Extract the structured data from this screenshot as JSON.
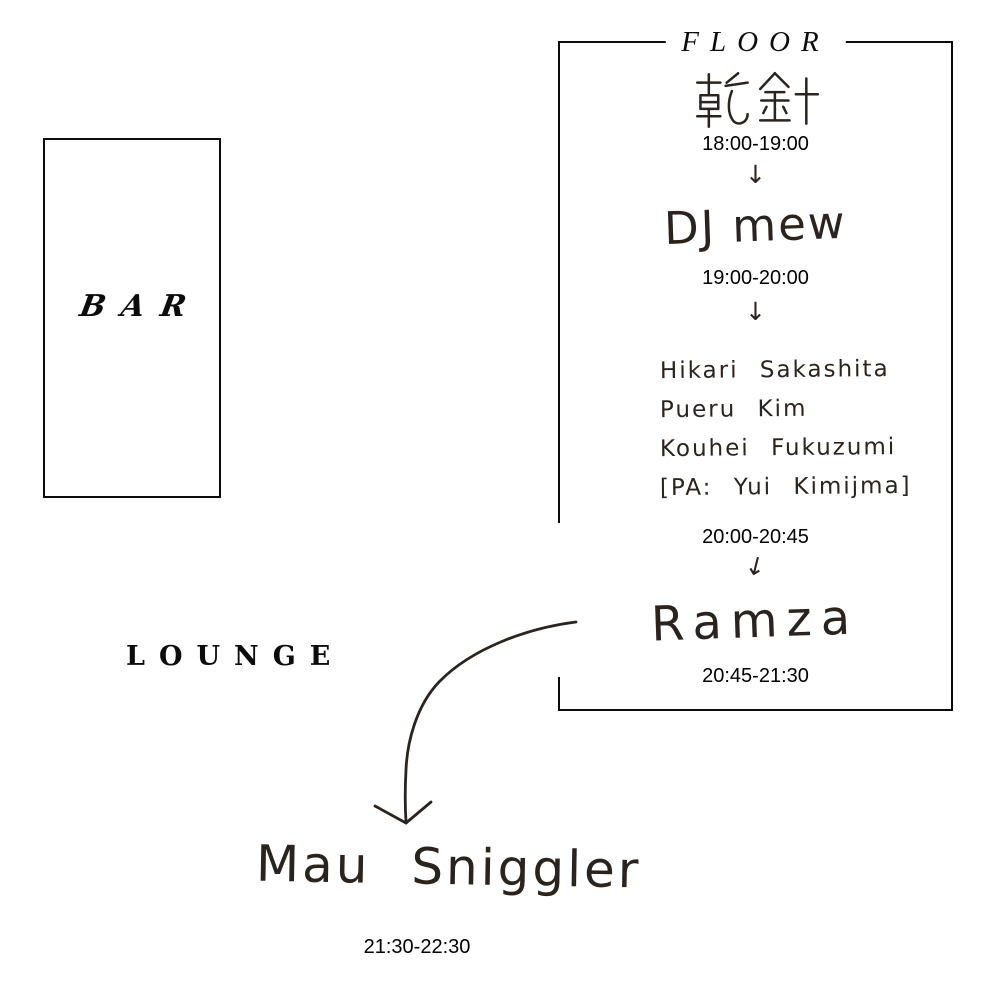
{
  "floor": {
    "label": "FLOOR",
    "schedule": [
      {
        "artist": "乾針",
        "time": "18:00-19:00"
      },
      {
        "artist": "DJ mew",
        "time": "19:00-20:00"
      },
      {
        "artist_lines": [
          "Hikari Sakashita",
          "Pueru Kim",
          "Kouhei Fukuzumi",
          "[PA: Yui Kimijma]"
        ],
        "time": "20:00-20:45"
      },
      {
        "artist": "Ramza",
        "time": "20:45-21:30"
      }
    ]
  },
  "bar": {
    "label": "BAR"
  },
  "lounge": {
    "label": "LOUNGE",
    "act": {
      "artist": "Mau Sniggler",
      "time": "21:30-22:30"
    }
  },
  "icons": {
    "down_arrow": "↓",
    "curved_arrow": "curved-arrow-down-left"
  },
  "colors": {
    "ink": "#2b241e",
    "print_text": "#000000",
    "border": "#0c0c0c",
    "background": "#ffffff"
  }
}
